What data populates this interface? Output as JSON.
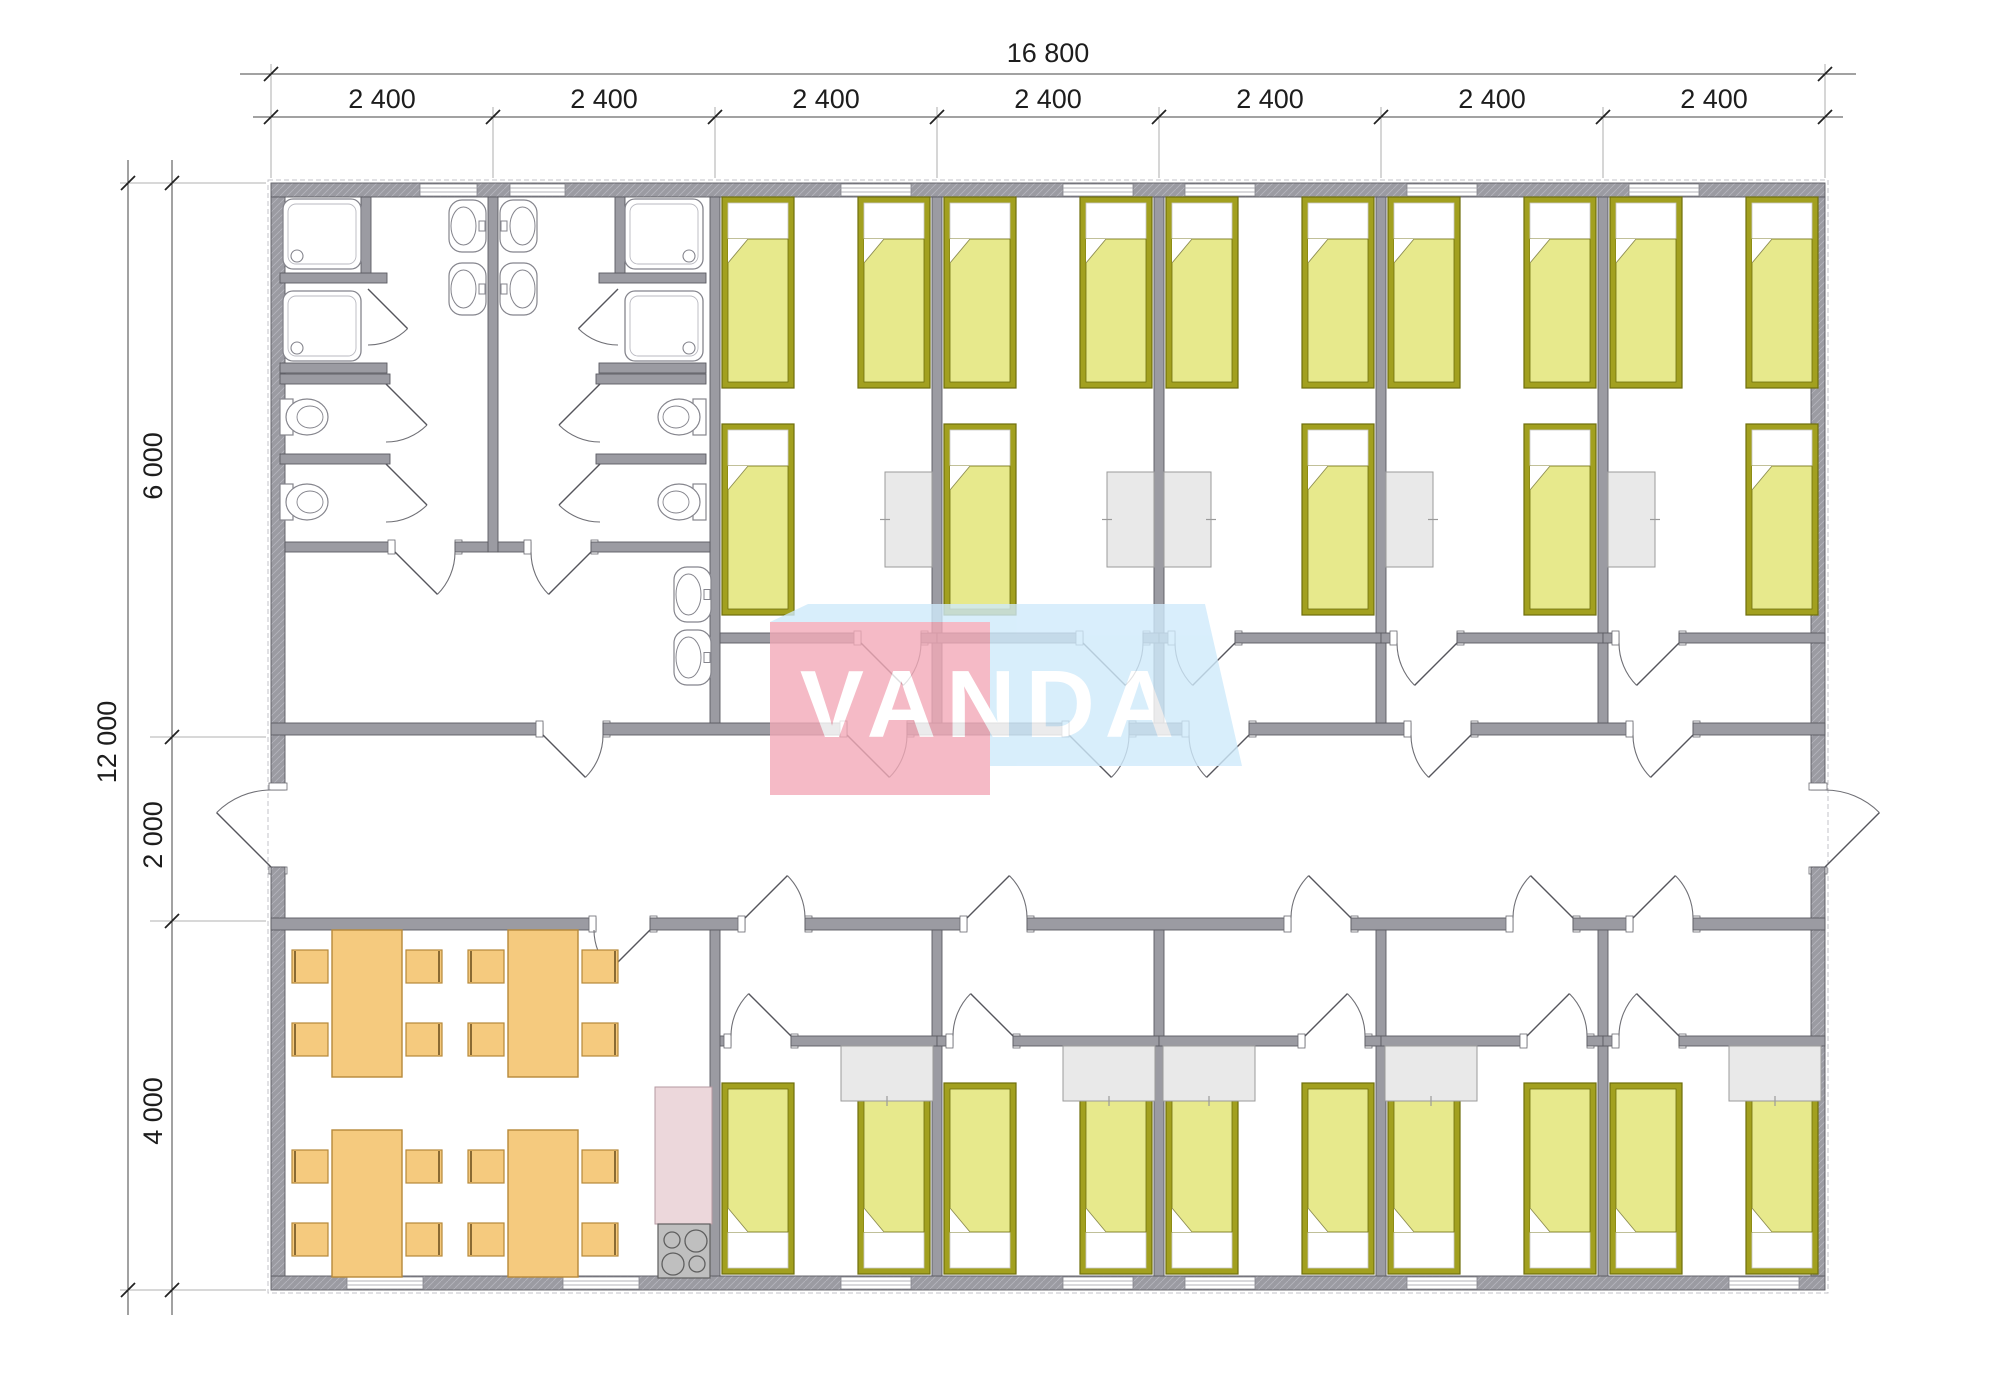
{
  "watermark": {
    "text": "VANDA",
    "panel_pink": "#f3aab8",
    "panel_blue": "#cfeafb",
    "text_color": "#ffffff"
  },
  "dimensions": {
    "top": {
      "total": "16 800",
      "segments": [
        "2 400",
        "2 400",
        "2 400",
        "2 400",
        "2 400",
        "2 400",
        "2 400"
      ]
    },
    "left": {
      "total": "12 000",
      "segments": [
        "6 000",
        "2 000",
        "4 000"
      ]
    }
  },
  "colors": {
    "wall": "#9b9ba2",
    "wall_stroke": "#5b5b62",
    "wall_hatch": "#b3b3bb",
    "bed_frame": "#a2a01f",
    "bed_frame_stroke": "#6f6e0c",
    "bed_blanket": "#e7e98c",
    "bed_pillow": "#ffffff",
    "desk_fill": "#e9e9e9",
    "desk_stroke": "#9b9b9b",
    "dining_fill": "#f5ca7e",
    "dining_stroke": "#b6893a",
    "chair_back": "#8a6a33",
    "kitchen_fill": "#ecd7db",
    "kitchen_stroke": "#b59aa2",
    "stove_fill": "#bfbfbf",
    "stove_stroke": "#5f5f5f",
    "fixture_stroke": "#85858d",
    "door_arc": "#6f6f75",
    "door_leaf": "#55555c",
    "dim_line": "#444444",
    "dim_ext": "#999999",
    "dim_tick": "#222222"
  },
  "rooms": {
    "top_bedrooms": [
      {
        "name": "bedroom-1",
        "beds": 3,
        "desks": 1,
        "mirrored": false
      },
      {
        "name": "bedroom-2",
        "beds": 3,
        "desks": 1,
        "mirrored": false
      },
      {
        "name": "bedroom-3",
        "beds": 3,
        "desks": 1,
        "mirrored": true
      },
      {
        "name": "bedroom-4",
        "beds": 3,
        "desks": 1,
        "mirrored": true
      },
      {
        "name": "bedroom-5",
        "beds": 3,
        "desks": 1,
        "mirrored": true
      }
    ],
    "bottom_bedrooms": [
      {
        "name": "bedroom-6",
        "beds": 2,
        "desks": 1,
        "mirrored": false
      },
      {
        "name": "bedroom-7",
        "beds": 2,
        "desks": 1,
        "mirrored": false
      },
      {
        "name": "bedroom-8",
        "beds": 2,
        "desks": 1,
        "mirrored": true
      },
      {
        "name": "bedroom-9",
        "beds": 2,
        "desks": 1,
        "mirrored": true
      },
      {
        "name": "bedroom-10",
        "beds": 2,
        "desks": 1,
        "mirrored": false
      }
    ],
    "bathrooms": {
      "showers": 4,
      "wash_basins": 6,
      "toilets": 4
    },
    "dining_room": {
      "tables": 4,
      "chairs": 16
    },
    "kitchen": {
      "stove_burners": 4
    }
  }
}
